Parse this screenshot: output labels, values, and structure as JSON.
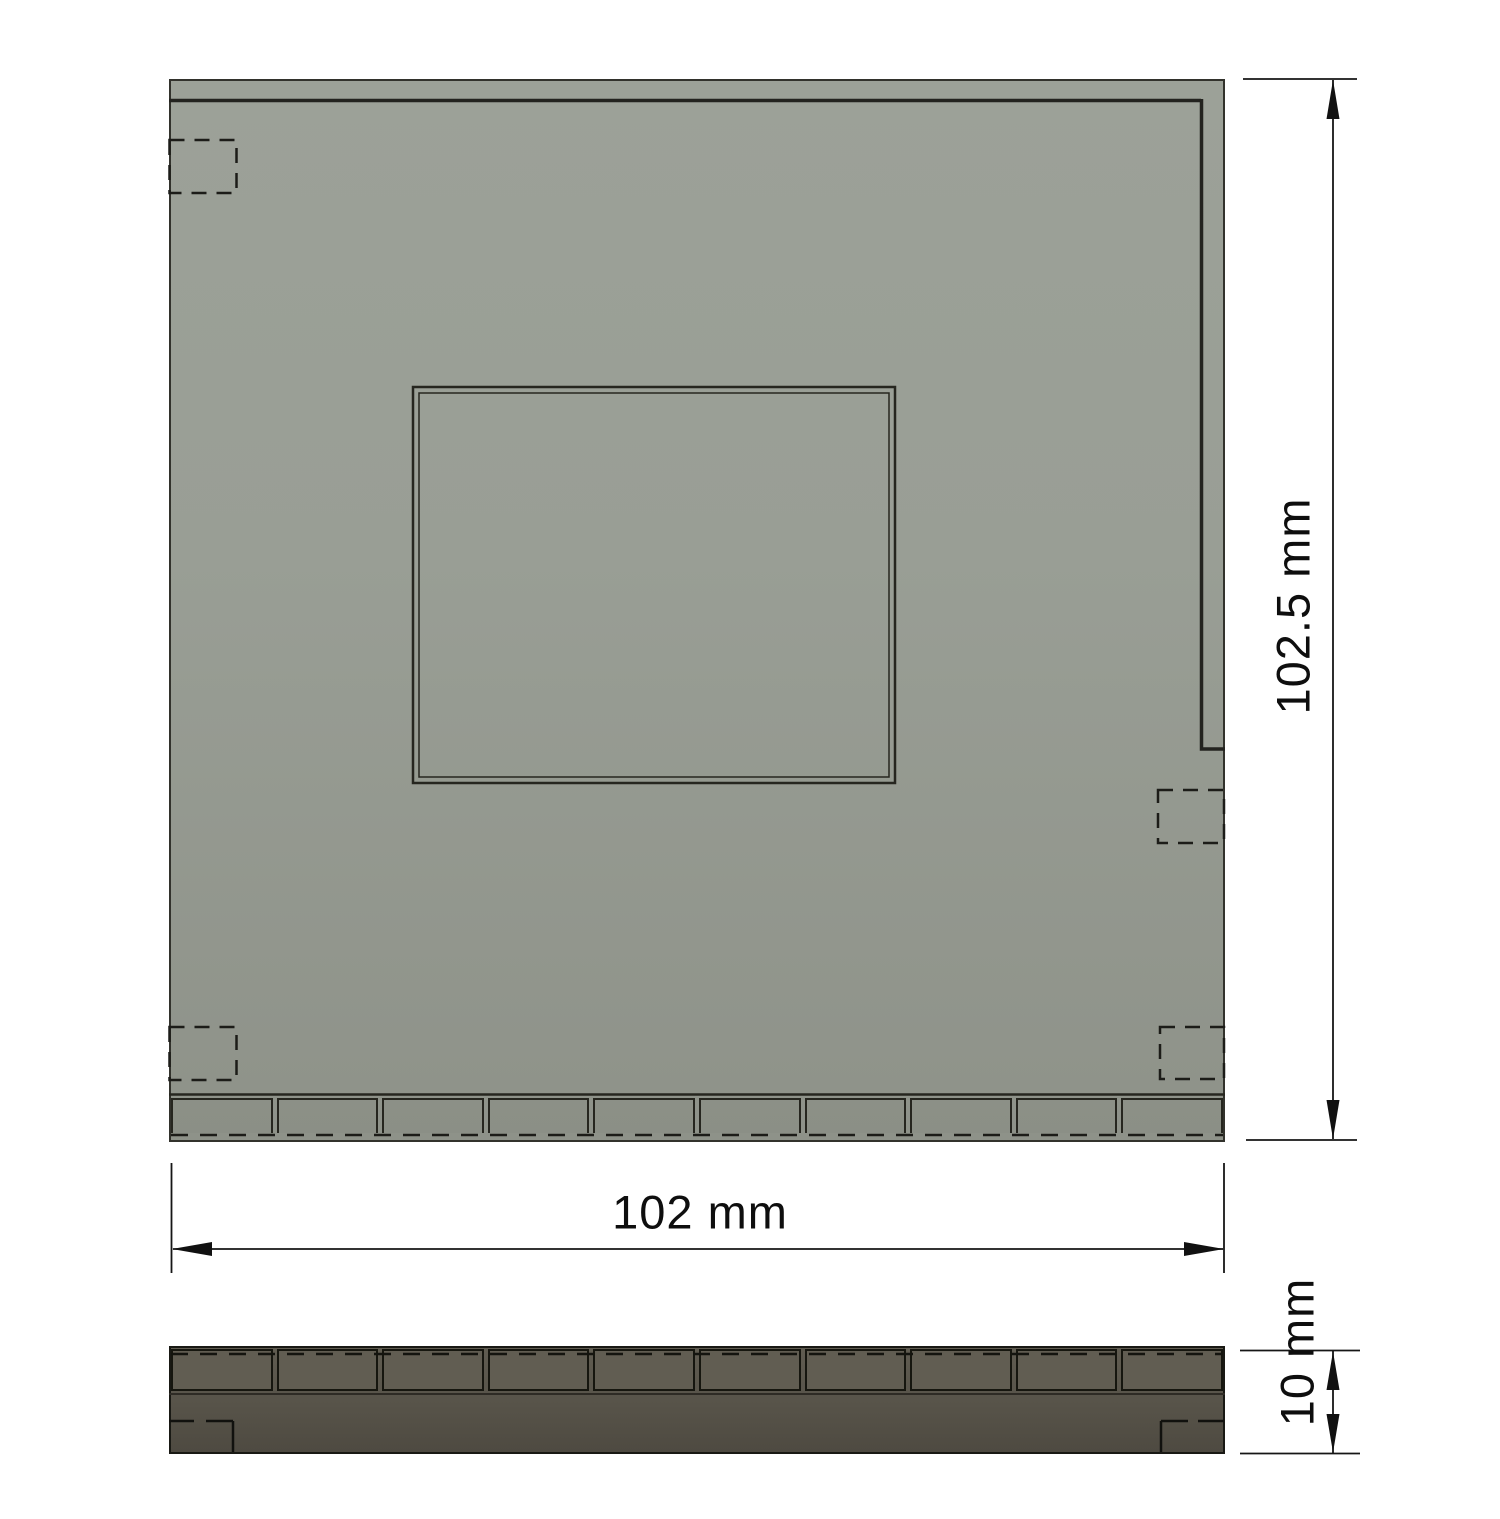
{
  "drawing": {
    "dimensions": {
      "overall_height_label": "102.5 mm",
      "overall_width_label": "102 mm",
      "thickness_label": "10 mm"
    },
    "top_view": {
      "tab_segment_count": 10,
      "corner_tab_count": 4
    },
    "side_view": {
      "tab_segment_count": 10
    },
    "colors": {
      "background": "#ffffff",
      "plate_fill_light": "#9aa096",
      "plate_fill_dark": "#8e9289",
      "side_fill_light": "#615d52",
      "side_fill_dark": "#4e4a41",
      "edge_line": "#26261f",
      "dimension_line": "#161616",
      "dimension_text": "#0e0e0e"
    }
  }
}
